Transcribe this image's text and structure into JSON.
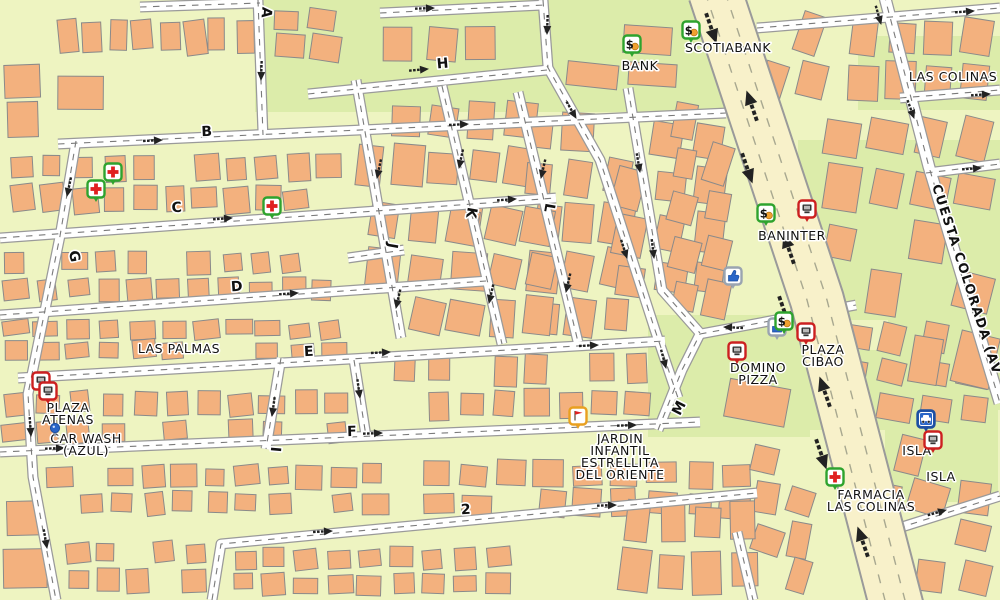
{
  "map": {
    "colors": {
      "base": "#eef4c1",
      "green_area": "#dcecaa",
      "building": "#f3b17e",
      "building_stroke": "#8a8a8a",
      "road_fill": "#ffffff",
      "road_casing": "#9a9a9a",
      "road_dash": "#7a7a7a",
      "highway_fill": "#f8f1ca",
      "highway_lane": "#a8a890",
      "arrow": "#222222",
      "label": "#111111",
      "halo": "#ffffff",
      "bank_green": "#2ea32e",
      "poi_red": "#cc2020",
      "poi_blue": "#2a66c8",
      "poi_orange": "#e8a020"
    },
    "street_labels": [
      {
        "text": "A",
        "x": 262,
        "y": 12,
        "rot": 95
      },
      {
        "text": "B",
        "x": 207,
        "y": 136,
        "rot": -3
      },
      {
        "text": "C",
        "x": 177,
        "y": 212,
        "rot": -4
      },
      {
        "text": "D",
        "x": 237,
        "y": 291,
        "rot": -4
      },
      {
        "text": "E",
        "x": 309,
        "y": 356,
        "rot": -3
      },
      {
        "text": "F",
        "x": 352,
        "y": 436,
        "rot": -2
      },
      {
        "text": "G",
        "x": 70,
        "y": 257,
        "rot": 80
      },
      {
        "text": "H",
        "x": 443,
        "y": 68,
        "rot": -5
      },
      {
        "text": "I",
        "x": 271,
        "y": 449,
        "rot": 95
      },
      {
        "text": "J",
        "x": 388,
        "y": 245,
        "rot": 100
      },
      {
        "text": "K",
        "x": 467,
        "y": 212,
        "rot": 100
      },
      {
        "text": "L",
        "x": 545,
        "y": 207,
        "rot": 100
      },
      {
        "text": "M",
        "x": 683,
        "y": 410,
        "rot": -63
      },
      {
        "text": "2",
        "x": 466,
        "y": 514,
        "rot": -3
      }
    ],
    "road_name_label": {
      "text": "CUESTA COLORADA (AV",
      "x": 932,
      "y": 186,
      "rot": 72
    },
    "area_labels": [
      {
        "lines": [
          "LAS PALMAS"
        ],
        "x": 179,
        "y": 353
      },
      {
        "lines": [
          "LAS COLINAS"
        ],
        "x": 953,
        "y": 81
      }
    ],
    "pois": [
      {
        "icon": "bank-icon",
        "x": 632,
        "y": 44,
        "label": {
          "lines": [
            "BANK"
          ],
          "x": 640,
          "y": 70
        }
      },
      {
        "icon": "bank-icon",
        "x": 691,
        "y": 30,
        "label": {
          "lines": [
            "SCOTIABANK"
          ],
          "x": 728,
          "y": 52
        }
      },
      {
        "icon": "bank-icon",
        "x": 766,
        "y": 213,
        "label": {
          "lines": [
            "BANINTER"
          ],
          "x": 792,
          "y": 240
        }
      },
      {
        "icon": "shop-icon",
        "x": 807,
        "y": 209
      },
      {
        "icon": "thumbsup-icon",
        "x": 733,
        "y": 276
      },
      {
        "icon": "thumbsup-icon",
        "x": 777,
        "y": 327
      },
      {
        "icon": "bank-icon",
        "x": 784,
        "y": 321
      },
      {
        "icon": "shop-icon",
        "x": 806,
        "y": 332,
        "label": {
          "lines": [
            "PLAZA",
            "CIBAO"
          ],
          "x": 823,
          "y": 354
        }
      },
      {
        "icon": "shop-icon",
        "x": 737,
        "y": 351,
        "label": {
          "lines": [
            "DOMINO",
            "PIZZA"
          ],
          "x": 758,
          "y": 372
        }
      },
      {
        "icon": "shop-icon",
        "x": 41,
        "y": 381
      },
      {
        "icon": "shop-icon",
        "x": 48,
        "y": 391,
        "label": {
          "lines": [
            "PLAZA",
            "ATENAS"
          ],
          "x": 68,
          "y": 412
        }
      },
      {
        "icon": "carwash-icon",
        "x": 55,
        "y": 428,
        "label": {
          "lines": [
            "CAR WASH",
            "(AZUL)"
          ],
          "x": 86,
          "y": 443
        }
      },
      {
        "icon": "pharmacy-icon",
        "x": 113,
        "y": 172
      },
      {
        "icon": "pharmacy-icon",
        "x": 96,
        "y": 189
      },
      {
        "icon": "pharmacy-icon",
        "x": 272,
        "y": 206
      },
      {
        "icon": "school-icon",
        "x": 578,
        "y": 416,
        "label": {
          "lines": [
            "JARDIN",
            "INFANTIL",
            "ESTRELLITA",
            "DEL ORIENTE"
          ],
          "x": 620,
          "y": 443
        }
      },
      {
        "icon": "fuel-icon",
        "x": 926,
        "y": 419,
        "label": {
          "lines": [
            "ISLA"
          ],
          "x": 917,
          "y": 455
        }
      },
      {
        "icon": "shop-icon",
        "x": 933,
        "y": 440,
        "label": {
          "lines": [
            "ISLA"
          ],
          "x": 941,
          "y": 481
        }
      },
      {
        "icon": "pharmacy-icon",
        "x": 835,
        "y": 477,
        "label": {
          "lines": [
            "FARMACIA",
            "LAS COLINAS"
          ],
          "x": 871,
          "y": 499
        }
      }
    ]
  }
}
